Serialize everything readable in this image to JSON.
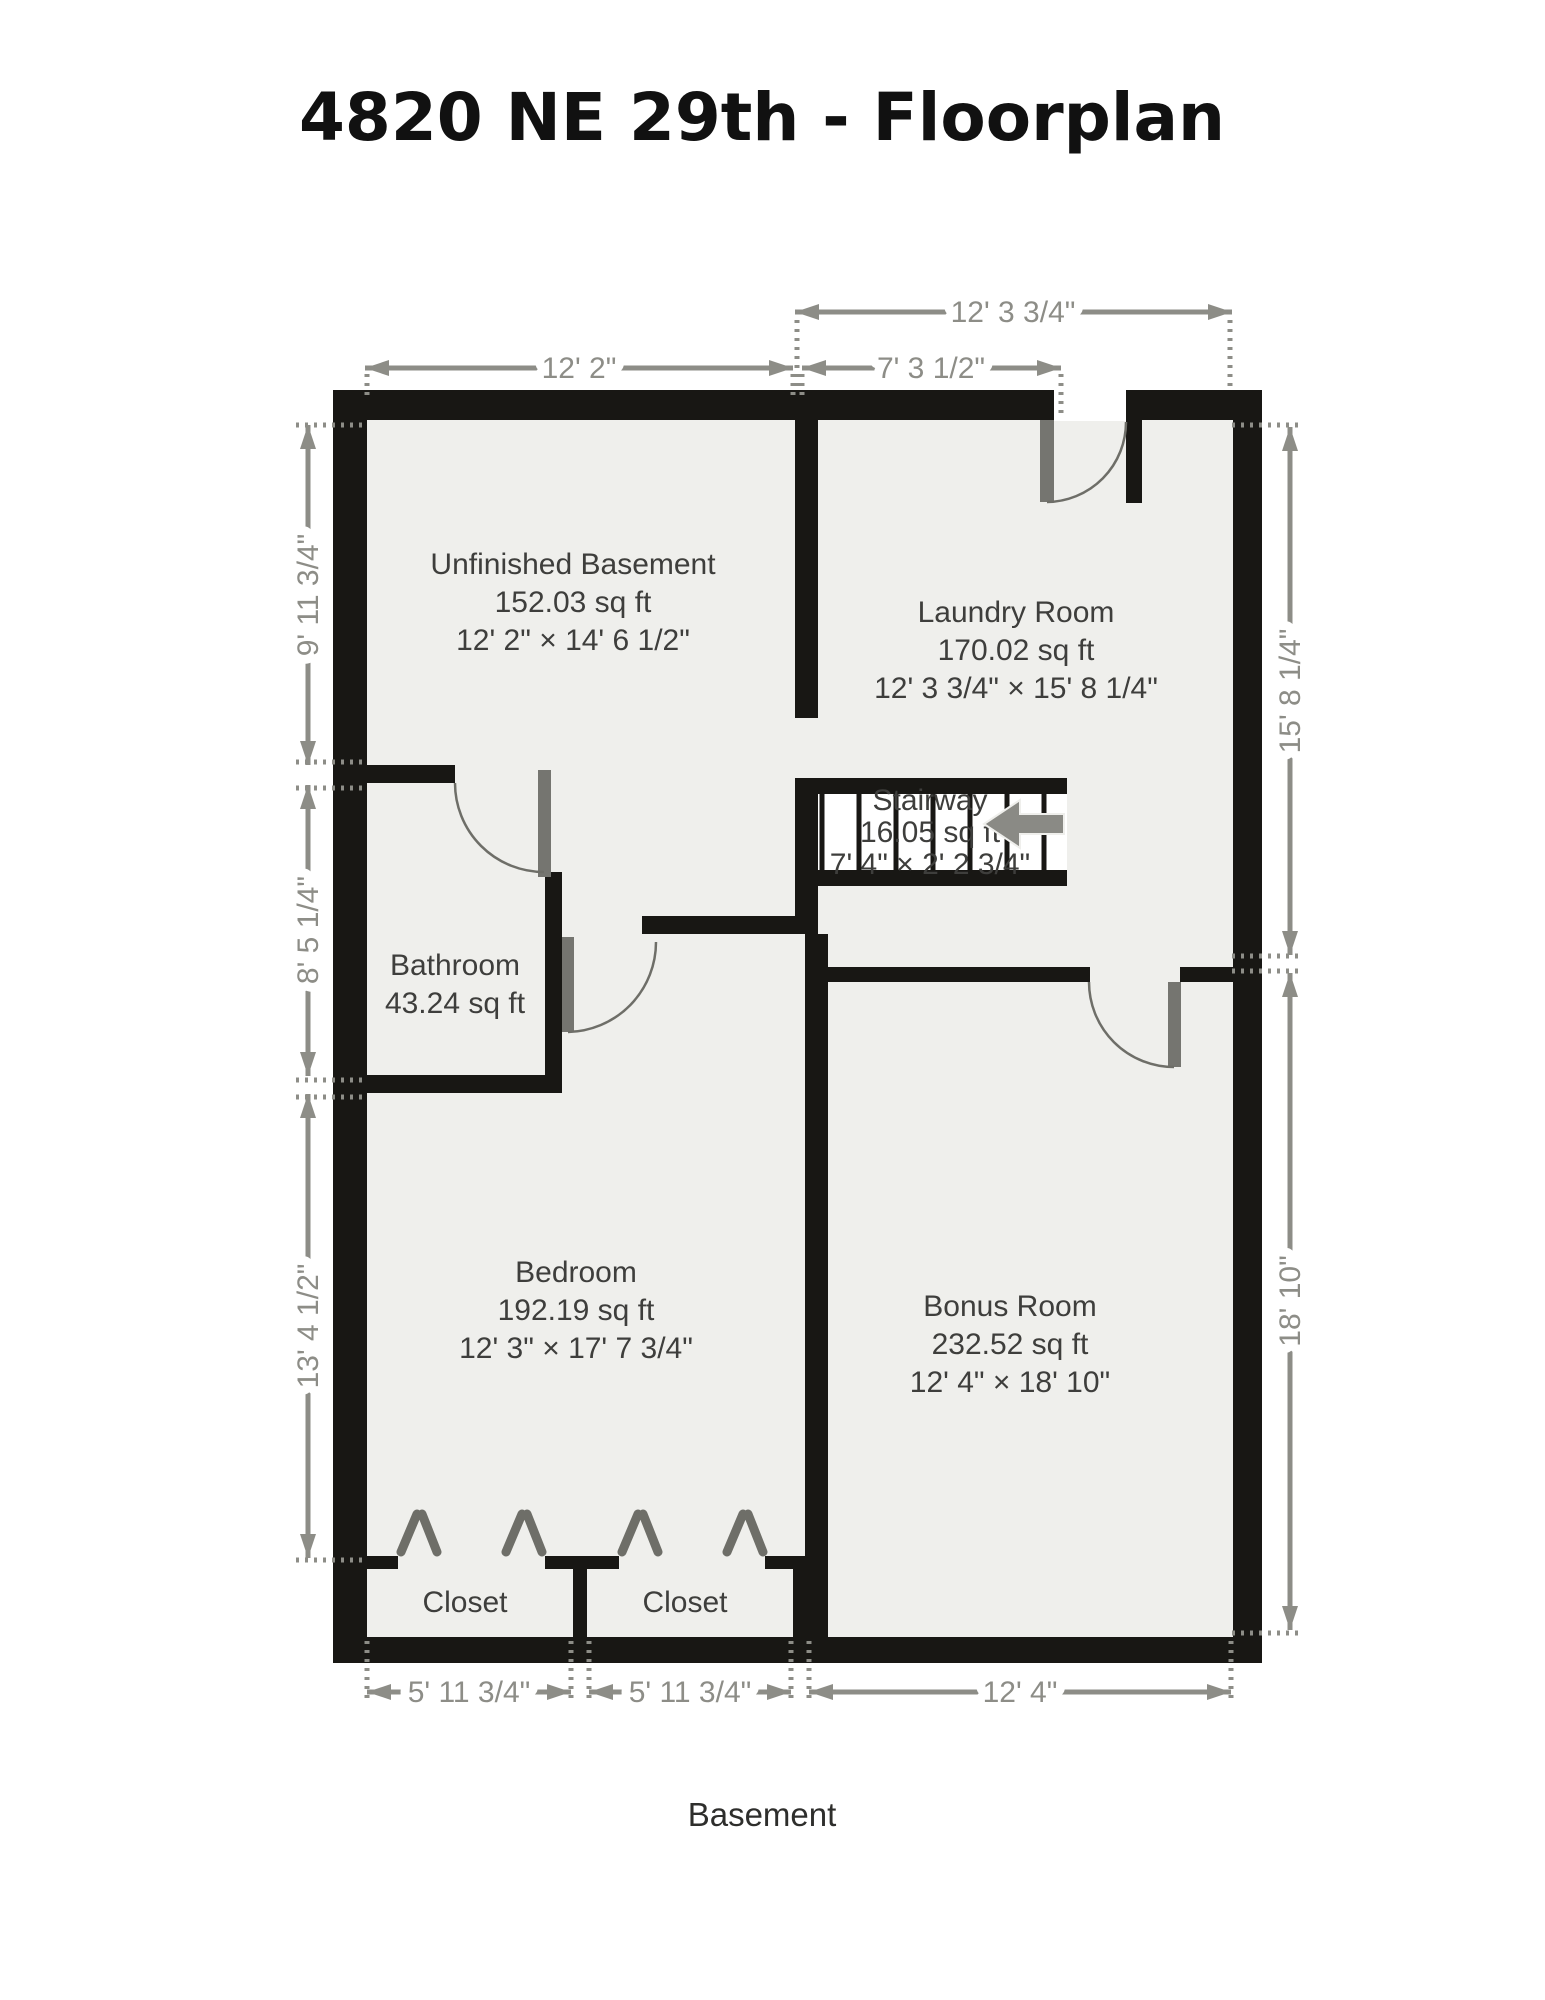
{
  "title": "4820 NE 29th - Floorplan",
  "floor_label": "Basement",
  "colors": {
    "wall": "#181714",
    "floor": "#efefec",
    "dimension": "#8d8d87",
    "room_label": "#3e3e3c",
    "door": "#757570"
  },
  "rooms": [
    {
      "name": "Unfinished Basement",
      "area": "152.03 sq ft",
      "dims": "12' 2\" × 14' 6 1/2\""
    },
    {
      "name": "Laundry Room",
      "area": "170.02 sq ft",
      "dims": "12' 3 3/4\" × 15' 8 1/4\""
    },
    {
      "name": "Stairway",
      "area": "16.05 sq ft",
      "dims": "7' 4\" × 2' 2 3/4\""
    },
    {
      "name": "Bathroom",
      "area": "43.24 sq ft"
    },
    {
      "name": "Bedroom",
      "area": "192.19 sq ft",
      "dims": "12' 3\" × 17' 7 3/4\""
    },
    {
      "name": "Bonus Room",
      "area": "232.52 sq ft",
      "dims": "12' 4\" × 18' 10\""
    },
    {
      "name": "Closet"
    },
    {
      "name": "Closet"
    }
  ],
  "dimensions": {
    "top_outer": "12' 3 3/4\"",
    "top_left": "12' 2\"",
    "top_right": "7' 3 1/2\"",
    "left_upper": "9' 11 3/4\"",
    "left_middle": "8' 5 1/4\"",
    "left_lower": "13' 4 1/2\"",
    "right_upper": "15' 8 1/4\"",
    "right_lower": "18' 10\"",
    "bottom_left": "5' 11 3/4\"",
    "bottom_middle": "5' 11 3/4\"",
    "bottom_right": "12' 4\""
  }
}
